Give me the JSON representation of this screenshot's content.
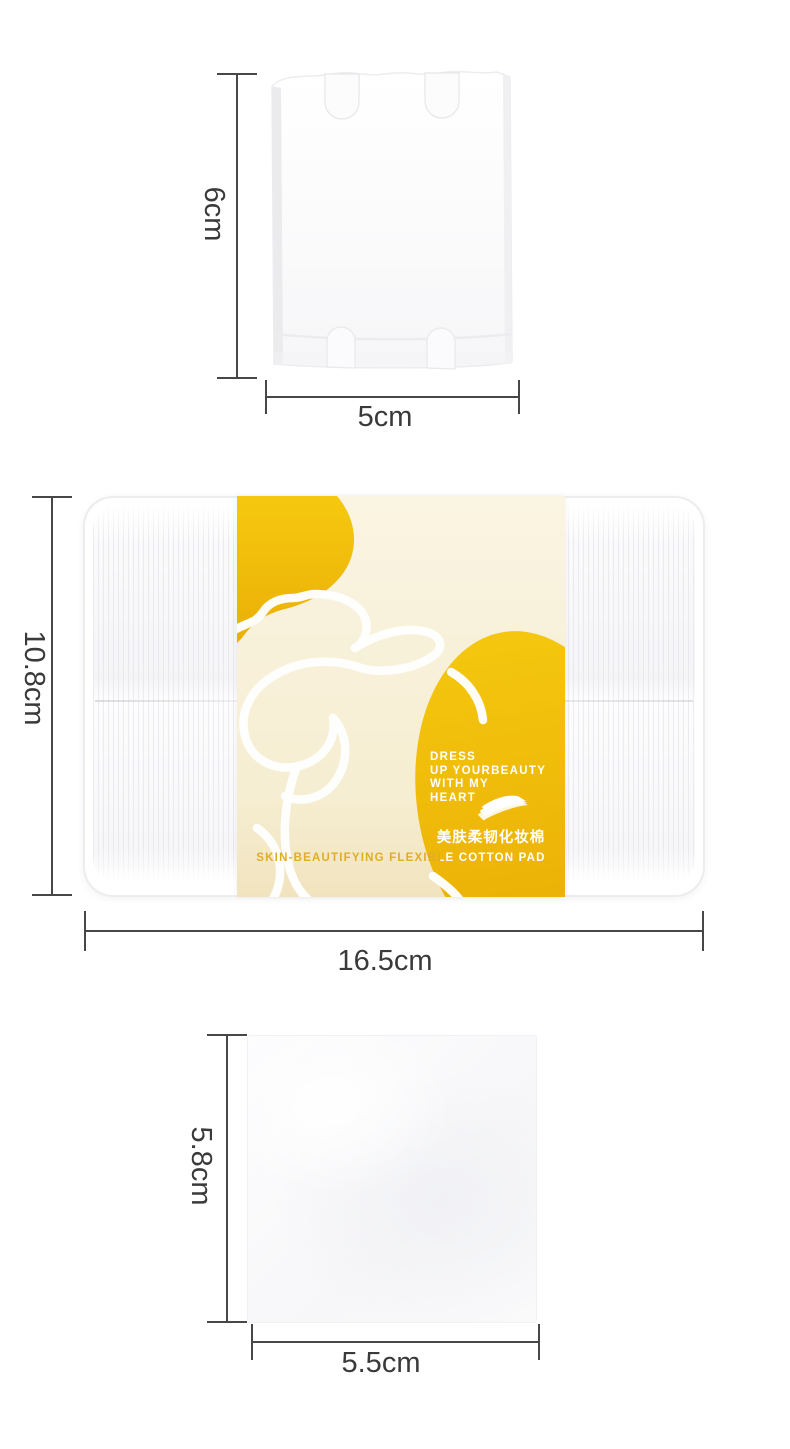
{
  "product": {
    "tagline": [
      "DRESS",
      "UP YOURBEAUTY",
      "WITH MY",
      "HEART"
    ],
    "name_cn": "美肤柔韧化妆棉",
    "name_en": "SKIN-BEAUTIFYING FLEXIBLE COTTON PAD"
  },
  "measurements": {
    "top_pad": {
      "height": "6cm",
      "width": "5cm"
    },
    "box": {
      "height": "10.8cm",
      "width": "16.5cm"
    },
    "bottom_pad": {
      "height": "5.8cm",
      "width": "5.5cm"
    }
  },
  "colors": {
    "accent_yellow": "#F2C10D",
    "label_cream": "#F7F0D6",
    "dimension_line": "#474747",
    "dimension_text": "#3A3A3A",
    "label_text_gold": "#DFAD26"
  },
  "icons": {
    "cotton_pad_stack_icon": "stack of cotton pads"
  }
}
